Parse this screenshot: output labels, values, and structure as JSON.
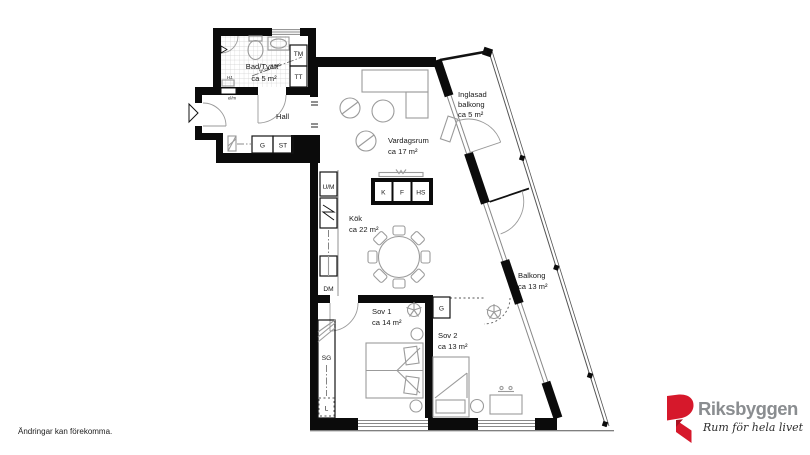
{
  "floorplan": {
    "rooms": {
      "bad": [
        "Bad/Tvätt",
        "ca 5 m²"
      ],
      "hall": [
        "Hall"
      ],
      "vardagsrum": [
        "Vardagsrum",
        "ca 17 m²"
      ],
      "kok": [
        "Kök",
        "ca 22 m²"
      ],
      "sov1": [
        "Sov 1",
        "ca 14 m²"
      ],
      "sov2": [
        "Sov 2",
        "ca 13 m²"
      ],
      "inglasad": [
        "Inglasad",
        "balkong",
        "ca 5 m²"
      ],
      "balkong": [
        "Balkong",
        "ca 13 m²"
      ]
    },
    "fixtures": {
      "tm": "TM",
      "tt": "TT",
      "g_hall": "G",
      "st": "ST",
      "um": "U/M",
      "dm": "DM",
      "k": "K",
      "f": "F",
      "hs": "HS",
      "sg": "SG",
      "l": "L",
      "g_sov2": "G"
    },
    "annotations": {
      "ceiling_note": "fri ca 2,3m",
      "meter": "el/m",
      "hj": "HJ."
    },
    "colors": {
      "wall": "#0b0b0b",
      "furniture": "#9b9b9b"
    }
  },
  "footer": {
    "disclaimer": "Ändringar kan förekomma."
  },
  "branding": {
    "company": "Riksbyggen",
    "tagline": "Rum för hela livet",
    "red": "#d6182b",
    "gray": "#8a8d90"
  }
}
